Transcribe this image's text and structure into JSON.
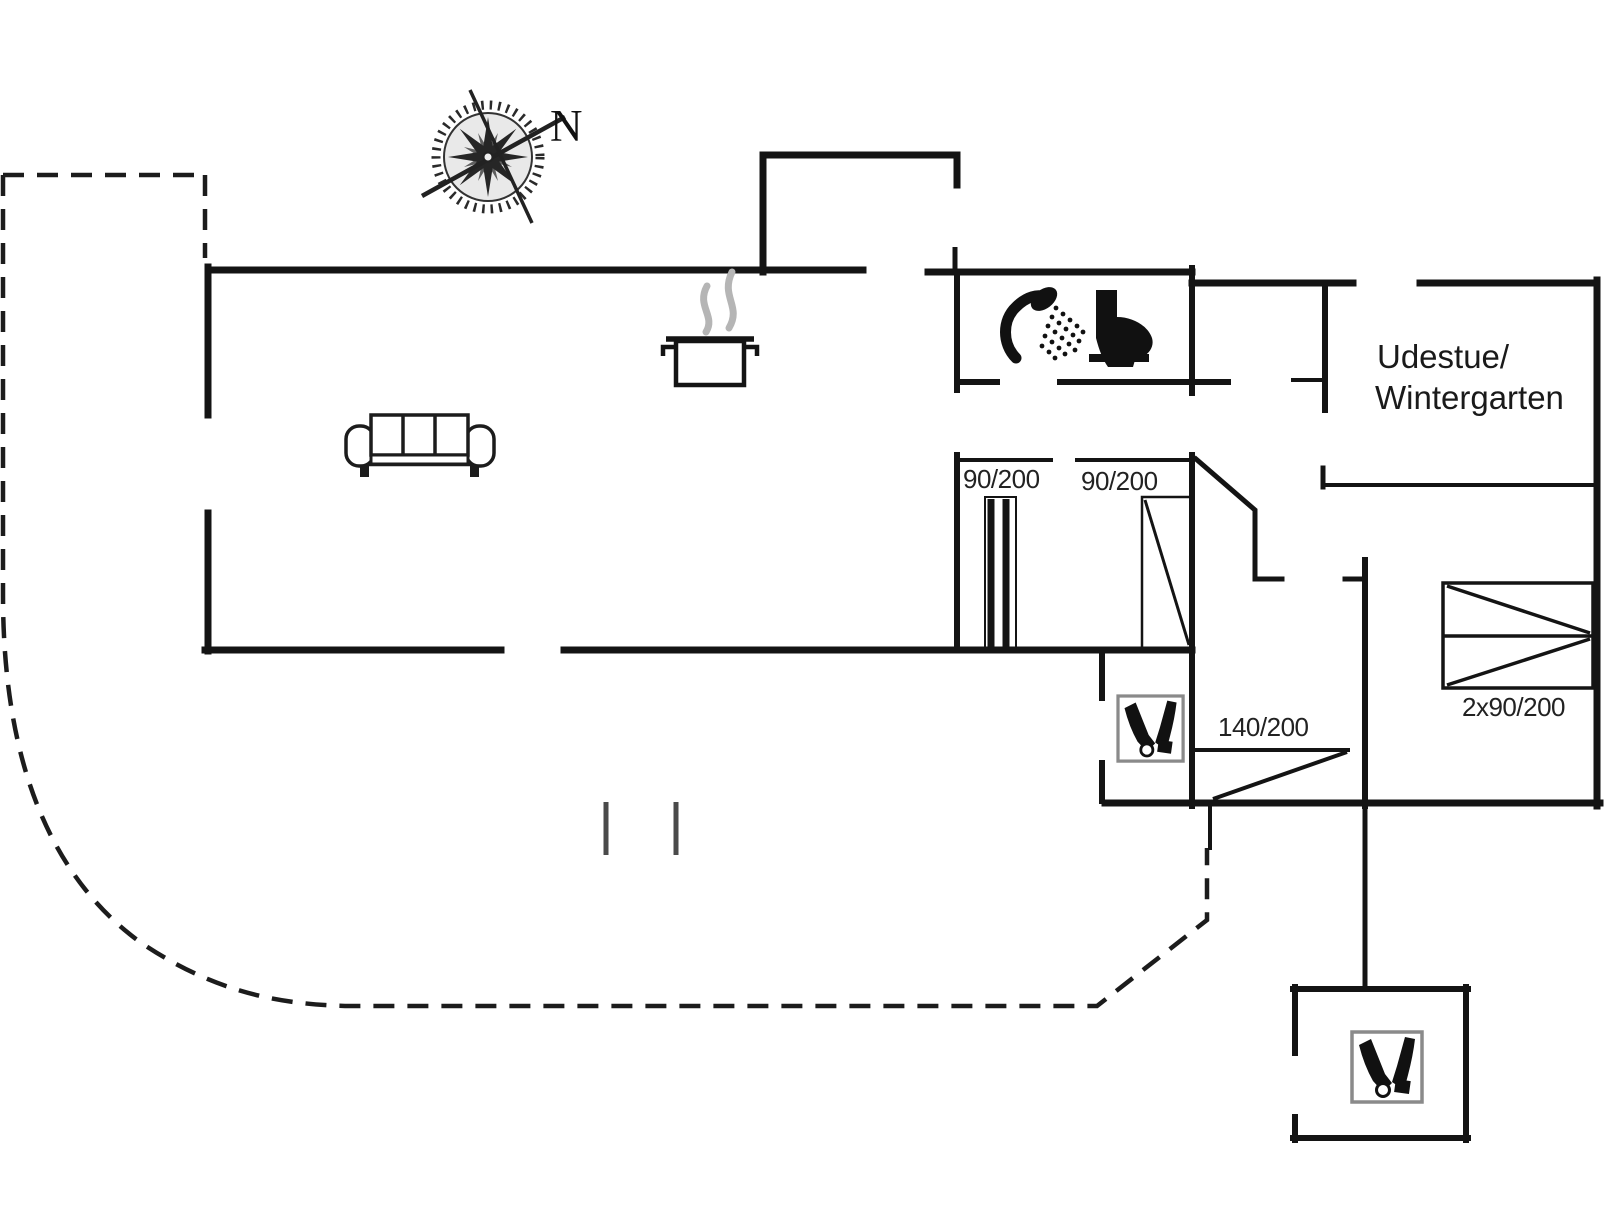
{
  "plan": {
    "type": "floor-plan",
    "compass_label": "N",
    "room_labels": {
      "sunroom_line1": "Udestue/",
      "sunroom_line2": "Wintergarten"
    },
    "door_labels": {
      "sliding_door": "90/200",
      "hinged_door": "90/200",
      "south_door": "140/200"
    },
    "bed_label": "2x90/200",
    "icons": [
      "compass-rose-icon",
      "sofa-icon",
      "cooking-pot-icon",
      "steam-icon",
      "shower-icon",
      "toilet-icon",
      "wood-stove-icon",
      "wood-stove-annex-icon",
      "double-bed-icon"
    ],
    "colors": {
      "wall": "#141414",
      "steam": "#b5b5b5",
      "stove_frame": "#8a8a8a",
      "dashed_boundary": "#1c1c1c",
      "background": "#ffffff"
    }
  }
}
